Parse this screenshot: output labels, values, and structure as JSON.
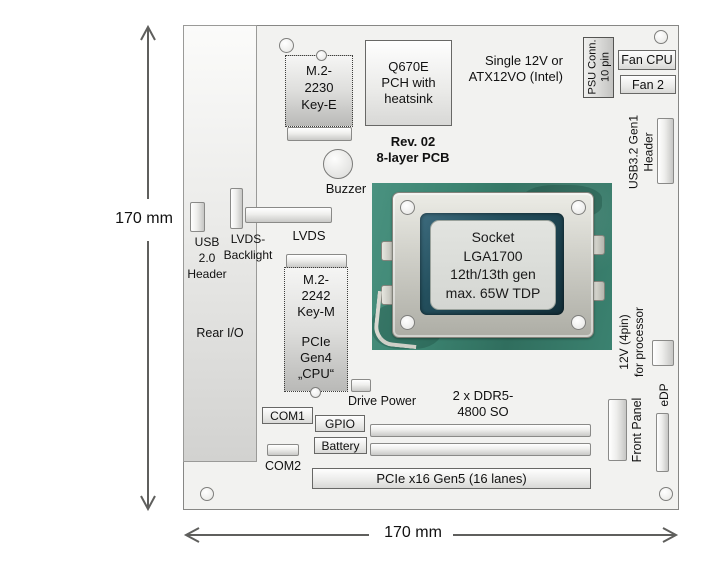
{
  "dimensions": {
    "left": "170 mm",
    "bottom": "170 mm"
  },
  "colors": {
    "board_fill": "#f2f2f0",
    "board_outline": "#878785",
    "pcb_green": "#3c8471",
    "socket_metal": "#d2d2cb",
    "socket_inner": "#24505e",
    "arrow": "#5f5f5d"
  },
  "components": {
    "rear_io": {
      "label": "Rear I/O"
    },
    "usb2_header": {
      "lines": [
        "USB",
        "2.0",
        "Header"
      ]
    },
    "lvds_backlight": {
      "lines": [
        "LVDS-",
        "Backlight"
      ]
    },
    "lvds": {
      "label": "LVDS"
    },
    "m2_2230": {
      "lines": [
        "M.2-",
        "2230",
        "Key-E"
      ]
    },
    "pch": {
      "lines": [
        "Q670E",
        "PCH with",
        "heatsink"
      ]
    },
    "rev_note": {
      "lines": [
        "Rev. 02",
        "8-layer PCB"
      ]
    },
    "buzzer": {
      "label": "Buzzer"
    },
    "psu_note": {
      "lines": [
        "Single 12V or",
        "ATX12VO (Intel)"
      ]
    },
    "psu_conn": {
      "lines": [
        "PSU Conn.",
        "10 pin"
      ]
    },
    "fan_cpu": {
      "label": "Fan CPU"
    },
    "fan_2": {
      "label": "Fan 2"
    },
    "usb32_header": {
      "lines": [
        "USB3.2 Gen1",
        "Header"
      ]
    },
    "cpu_socket": {
      "lines": [
        "Socket",
        "LGA1700",
        "12th/13th gen",
        "max. 65W TDP"
      ]
    },
    "m2_2242": {
      "top_lines": [
        "M.2-",
        "2242",
        "Key-M"
      ],
      "bottom_lines": [
        "PCIe",
        "Gen4",
        "„CPU“"
      ]
    },
    "drive_power": {
      "label": "Drive Power"
    },
    "com1": {
      "label": "COM1"
    },
    "gpio": {
      "label": "GPIO"
    },
    "battery": {
      "label": "Battery"
    },
    "com2": {
      "label": "COM2"
    },
    "ddr": {
      "lines": [
        "2 x DDR5-",
        "4800 SO"
      ]
    },
    "pcie_x16": {
      "label": "PCIe x16 Gen5 (16 lanes)"
    },
    "front_panel": {
      "label": "Front Panel"
    },
    "cpu_12v": {
      "lines": [
        "12V (4pin)",
        "for processor"
      ]
    },
    "edp": {
      "label": "eDP"
    }
  }
}
